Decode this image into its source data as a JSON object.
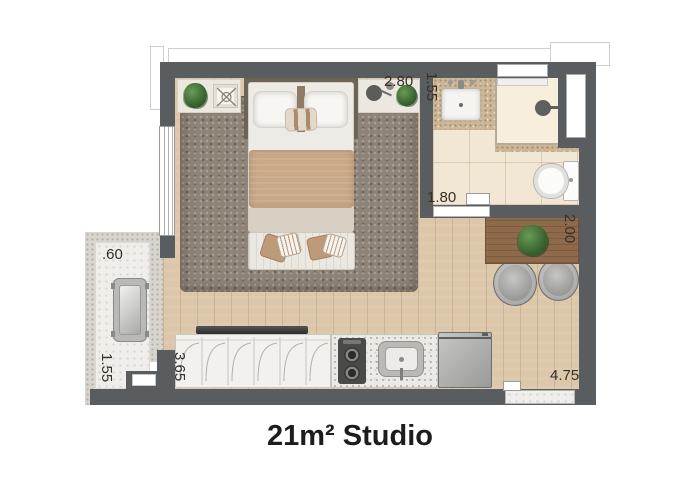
{
  "title": "21m² Studio",
  "dimensions": {
    "bedroom_width": "2.80",
    "bathroom_width": "1.55",
    "bathroom_length": "1.80",
    "desk_wall_length": "2.00",
    "balcony_depth": ".60",
    "balcony_length": "1.55",
    "kitchen_run_length": "3.65",
    "apartment_length": "4.75"
  },
  "colors": {
    "wall": "#595d5f",
    "wood_floor": "#dcc7ab",
    "bathroom_tile": "#f2e7d4",
    "rug": "#8e8377",
    "desk_wood": "#8e6a4b",
    "balcony_floor": "#f0eeea",
    "plant_green": "#3c6f38",
    "dimension_text": "#35302b",
    "title_text": "#1d1d1d"
  }
}
